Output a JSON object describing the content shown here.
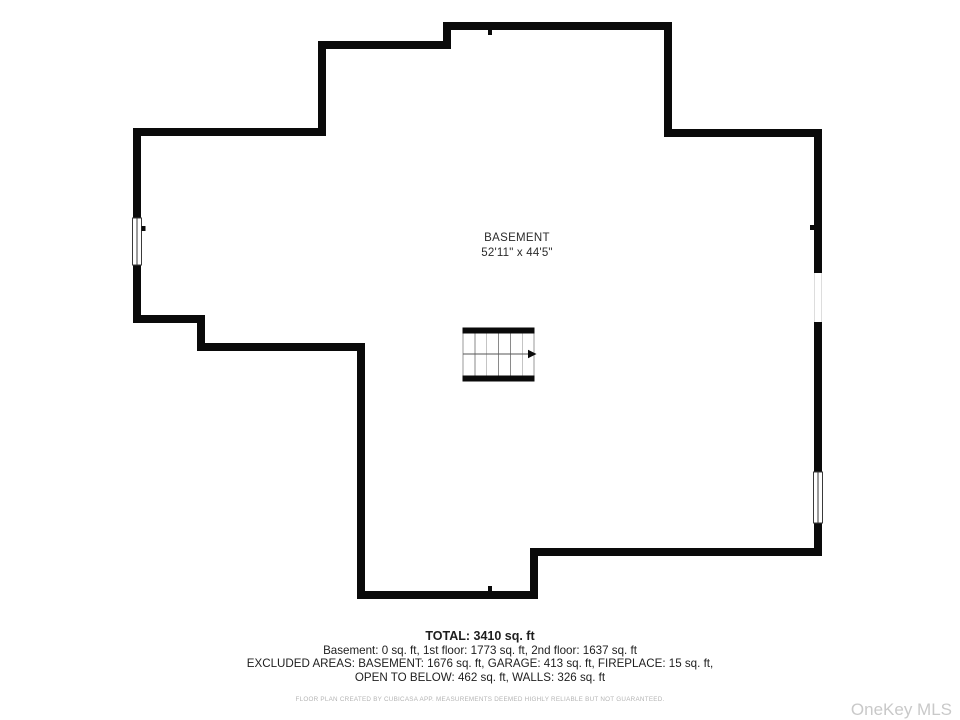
{
  "plan": {
    "room_label": "BASEMENT",
    "room_dimensions": "52'11\" x 44'5\"",
    "features": {
      "stairs": "staircase with up-direction arrow pointing right",
      "left_wall_window": "window symbol",
      "right_wall_opening": "wall opening",
      "right_wall_window": "window symbol"
    },
    "colors": {
      "wall": "#0a0a0a",
      "text": "#1e1e1e",
      "muted_text": "#b4b4b4",
      "watermark": "#c9c9c9",
      "stair_line": "#888888"
    }
  },
  "summary": {
    "total": "TOTAL: 3410 sq. ft",
    "floors": "Basement: 0 sq. ft, 1st floor: 1773 sq. ft, 2nd floor: 1637 sq. ft",
    "excluded_line1": "EXCLUDED AREAS: BASEMENT: 1676 sq. ft, GARAGE: 413 sq. ft, FIREPLACE: 15 sq. ft,",
    "excluded_line2": "OPEN TO BELOW: 462 sq. ft, WALLS: 326 sq. ft"
  },
  "footer": {
    "disclaimer": "FLOOR PLAN CREATED BY CUBICASA APP. MEASUREMENTS DEEMED HIGHLY RELIABLE BUT NOT GUARANTEED.",
    "watermark": "OneKey MLS"
  }
}
